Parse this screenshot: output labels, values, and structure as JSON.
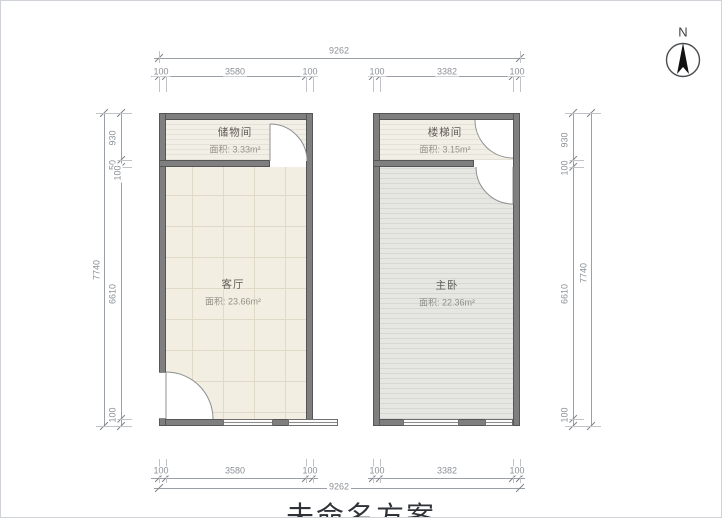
{
  "north": {
    "label": "N"
  },
  "title": {
    "text": "未命名方案"
  },
  "colors": {
    "wall": "#7f7f7f",
    "floor_beige": "#f2eee2",
    "floor_gray": "#e6e6e2",
    "floor_warm_light": "#f2efe7",
    "dimension_text": "#8b9197"
  },
  "rooms": {
    "storage": {
      "name": "储物间",
      "area": "面积: 3.33m²"
    },
    "living": {
      "name": "客厅",
      "area": "面积: 23.66m²"
    },
    "stair": {
      "name": "楼梯间",
      "area": "面积: 3.15m²"
    },
    "master": {
      "name": "主卧",
      "area": "面积: 22.36m²"
    }
  },
  "dims": {
    "top": {
      "overall": "9262",
      "left": [
        "100",
        "3580",
        "100"
      ],
      "right": [
        "100",
        "3382",
        "100"
      ]
    },
    "bottom": {
      "overall": "9262",
      "left": [
        "100",
        "3580",
        "100"
      ],
      "right": [
        "100",
        "3382",
        "100"
      ]
    },
    "left": {
      "overall": "7740",
      "top_segments": [
        "930",
        "50",
        "100"
      ],
      "middle": "6610",
      "bottom": "100"
    },
    "right": {
      "overall": "7740",
      "top_segments": [
        "930",
        "100"
      ],
      "middle": "6610",
      "bottom": "100"
    }
  }
}
